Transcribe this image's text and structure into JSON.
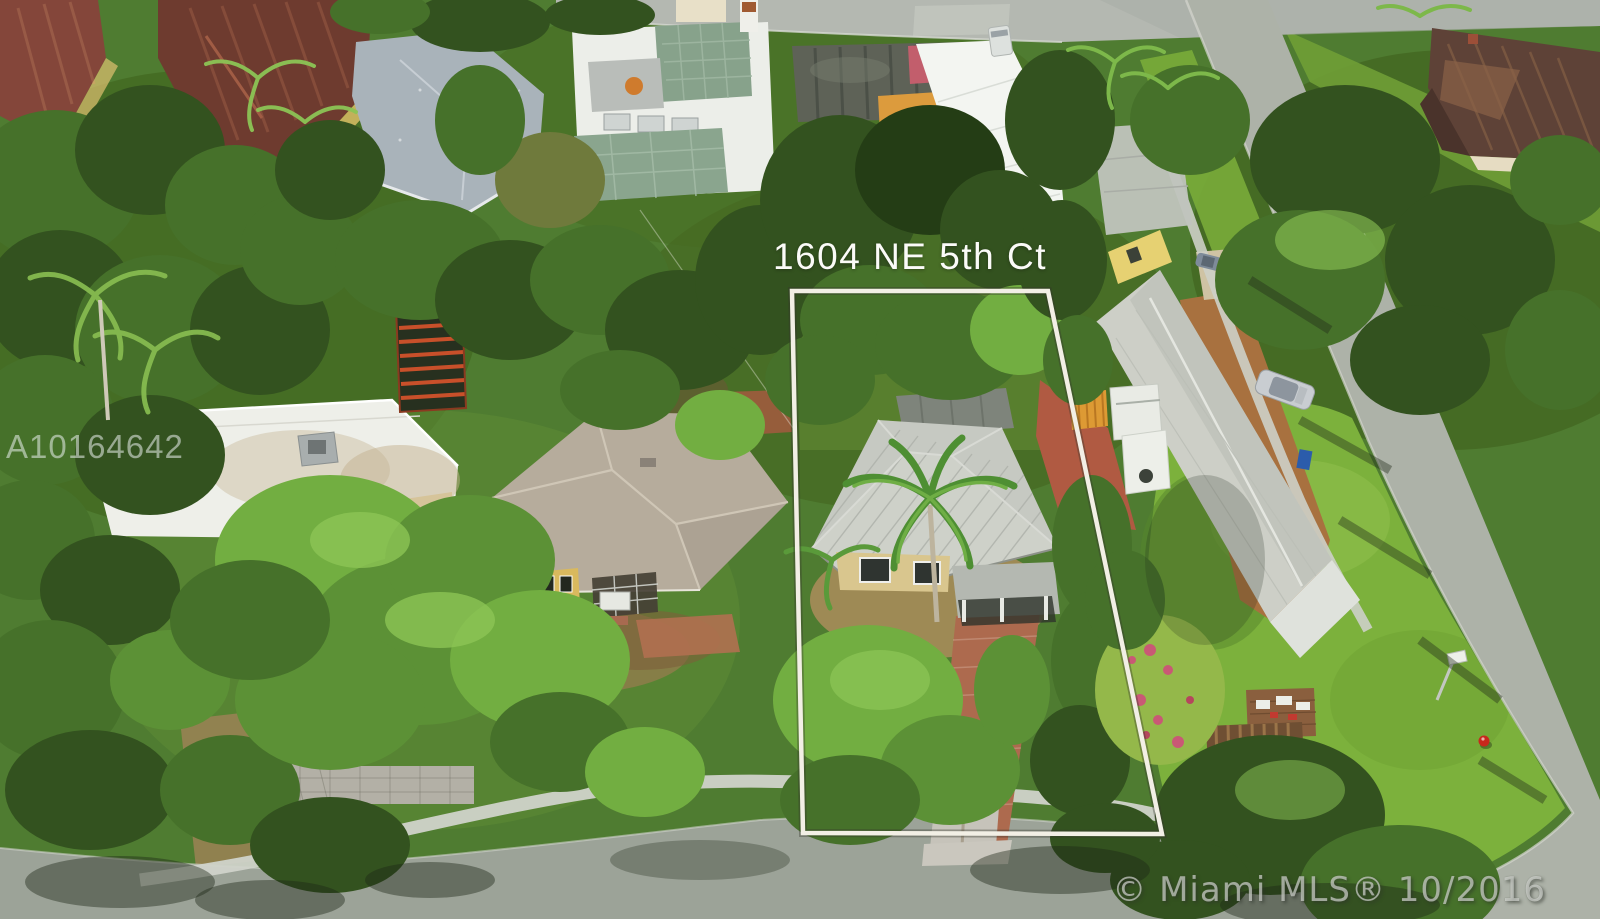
{
  "photo": {
    "kind": "aerial-drone-listing-photo",
    "description": "Aerial view of a residential neighborhood with the subject lot outlined in white",
    "overlays": {
      "address_label": "1604 NE 5th Ct",
      "watermark_id": "A10164642",
      "copyright_stamp": "© Miami MLS® 10/2016"
    },
    "boundary": {
      "color": "#f2efe5",
      "shape": "quadrilateral around subject lot"
    },
    "palette": {
      "canopy_green": "#4f7c31",
      "lawn_green": "#7cb13c",
      "asphalt_gray": "#adb2a8",
      "subject_roof_gray": "#c6c9c2",
      "brick_driveway": "#ad6a4e",
      "terracotta_roof": "#6e3b2f"
    }
  }
}
